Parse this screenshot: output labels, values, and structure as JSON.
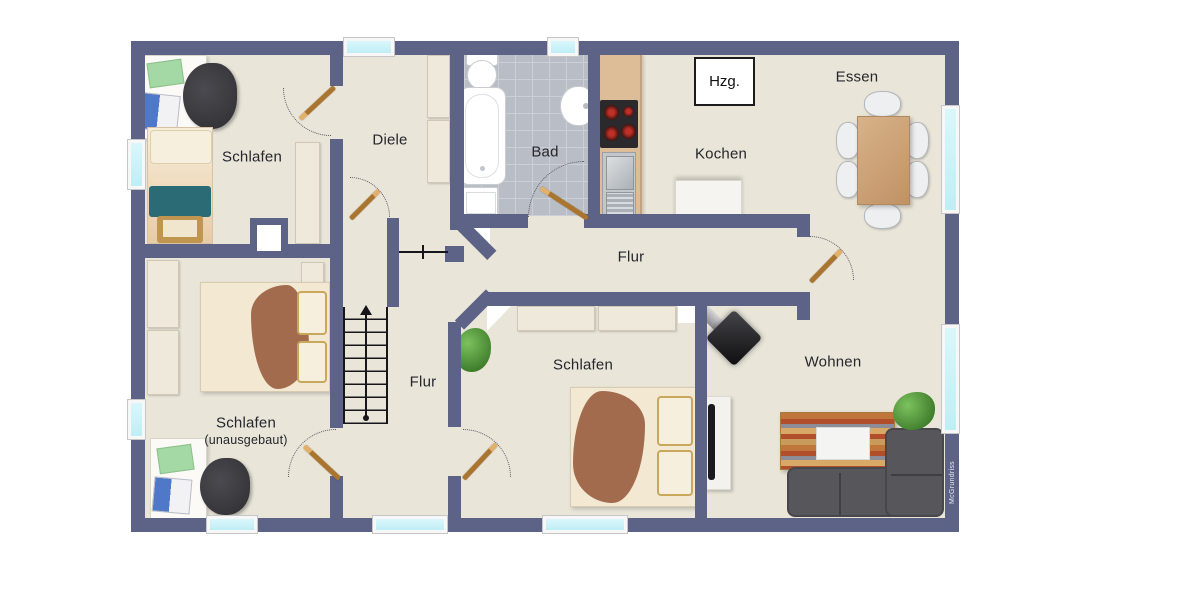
{
  "plan_title": "Obergeschoss Wohnung Grundriss",
  "brand": {
    "label": "McGrundriss"
  },
  "palette": {
    "wall": "#5c6386",
    "floor": "#e9e5d9",
    "outside": "#ffffff",
    "bath_tile": "#b9bdc5",
    "window_glass": "#c9f0f6",
    "door_wood": "#a9752f",
    "label_text": "#26262b",
    "teal_blanket": "#2a6b76",
    "duvet_brown": "#a26b4e",
    "sofa_gray": "#57575b",
    "table_wood": "#cfa273",
    "counter_tan": "#dcbd98",
    "plant_green": "#4e8f38"
  },
  "rooms": [
    {
      "id": "schlafen-oben-links",
      "label": "Schlafen"
    },
    {
      "id": "diele",
      "label": "Diele"
    },
    {
      "id": "bad",
      "label": "Bad"
    },
    {
      "id": "kochen",
      "label": "Kochen"
    },
    {
      "id": "essen",
      "label": "Essen"
    },
    {
      "id": "flur",
      "label": "Flur"
    },
    {
      "id": "flur-unten",
      "label": "Flur"
    },
    {
      "id": "schlafen-unausgebaut",
      "label": "Schlafen",
      "sublabel": "(unausgebaut)"
    },
    {
      "id": "schlafen-unten-mitte",
      "label": "Schlafen"
    },
    {
      "id": "wohnen",
      "label": "Wohnen"
    }
  ],
  "annotations": {
    "heating_label": "Hzg."
  },
  "features": {
    "stairs": "stairs-up-arrow",
    "windows_count": 9,
    "doors_count": 6,
    "fixtures": [
      "bathtub",
      "toilet",
      "sink",
      "washing-machine",
      "stove-top",
      "kitchen-sink",
      "fridge",
      "dining-table",
      "sofa",
      "sideboard",
      "tv",
      "wood-stove",
      "plants",
      "beds",
      "desks",
      "wardrobes"
    ]
  }
}
